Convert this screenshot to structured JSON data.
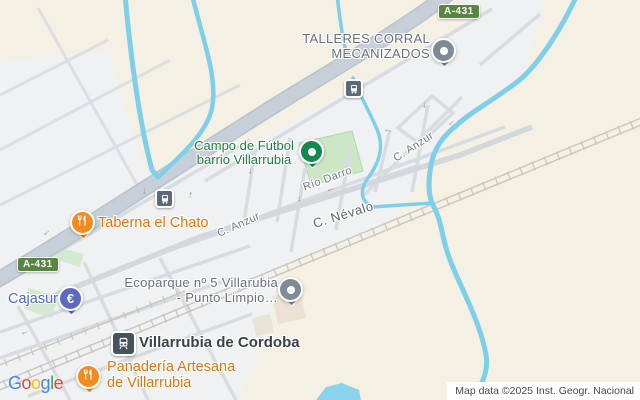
{
  "road_badges": {
    "top": "A-431",
    "left": "A-431"
  },
  "street_labels": {
    "rio_darro": "Río Darro",
    "anzur_left": "C. Anzur",
    "anzur_right": "C. Anzur",
    "nevalo": "C. Névalo"
  },
  "pois": {
    "talleres": {
      "line1": "TALLERES CORRAL",
      "line2": "MECANIZADOS",
      "color": "#66707d"
    },
    "campo": {
      "line1": "Campo de Fútbol",
      "line2": "barrio Villarrubia",
      "color": "#188038"
    },
    "taberna": {
      "label": "Taberna el Chato",
      "color": "#e8710a"
    },
    "cajasur": {
      "label": "Cajasur",
      "icon_glyph": "€",
      "color": "#4e67c8"
    },
    "ecoparque": {
      "line1": "Ecoparque nº 5 Villarubia",
      "line2": "- Punto Limpio…",
      "color": "#66707d"
    },
    "station": {
      "label": "Villarrubia de Cordoba",
      "color": "#3a4148"
    },
    "panaderia": {
      "line1": "Panadería Artesana",
      "line2": "de Villarrubia",
      "color": "#e8710a"
    }
  },
  "icons": {
    "arrow": "→"
  },
  "logo": {
    "letters": [
      "G",
      "o",
      "o",
      "g",
      "l",
      "e"
    ],
    "colors": [
      "#4285F4",
      "#EA4335",
      "#FBBC05",
      "#4285F4",
      "#34A853",
      "#EA4335"
    ]
  },
  "attribution": "Map data ©2025 Inst. Geogr. Nacional",
  "map_colors": {
    "landscape": "#f5f0e4",
    "urban": "#eff1f2",
    "water": "#7fceea",
    "field_green": "#cbe7c6",
    "road": "#c7d0d9",
    "railway": "#cbc5bc",
    "badge_green": "#588540"
  }
}
